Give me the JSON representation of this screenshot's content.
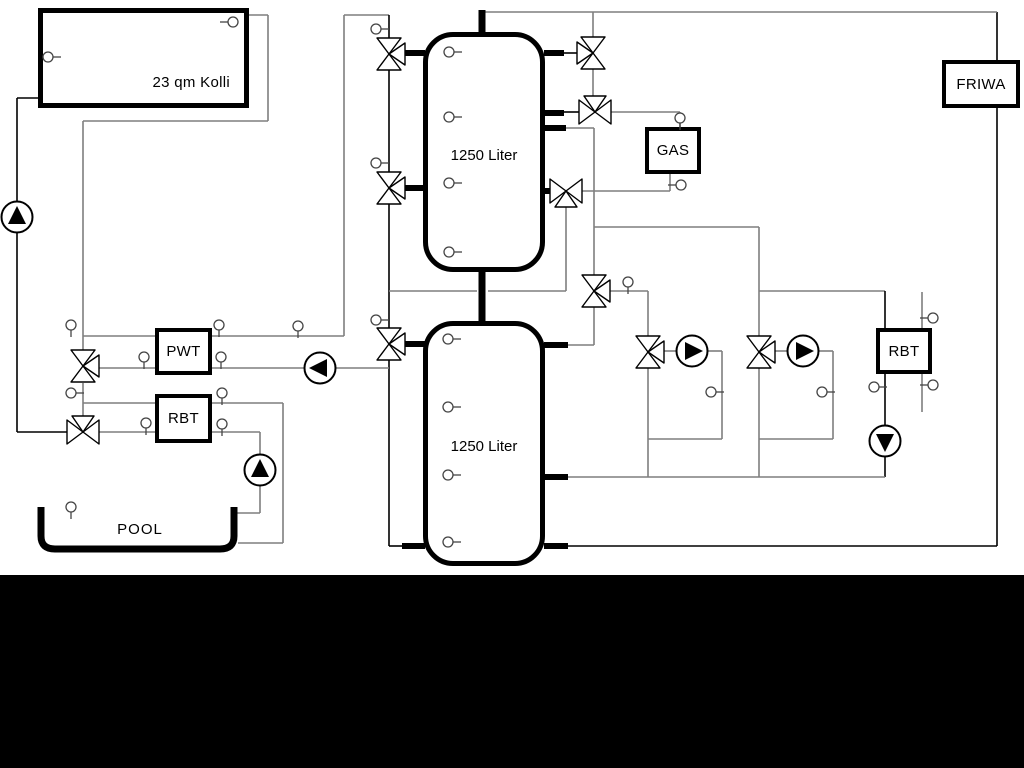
{
  "diagram": {
    "title": "solar-buffer-heating-scheme",
    "collector_label": "23 qm Kolli",
    "tank_upper_label": "1250 Liter",
    "tank_lower_label": "1250 Liter",
    "gas_label": "GAS",
    "friwa_label": "FRIWA",
    "pwt_label": "PWT",
    "rbt_left_label": "RBT",
    "rbt_right_label": "RBT",
    "pool_label": "POOL",
    "colors": {
      "pipe_gray": "#7f7f7f",
      "line_black": "#000000",
      "background": "#ffffff",
      "footer_bar": "#000000"
    }
  }
}
